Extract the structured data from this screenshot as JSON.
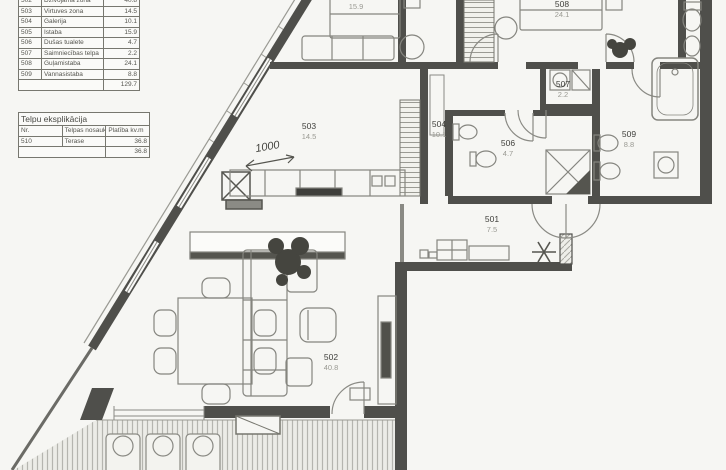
{
  "schedule": {
    "rows": [
      {
        "nr": "502",
        "name": "Dzīvojamā zona",
        "area": "40.8"
      },
      {
        "nr": "503",
        "name": "Virtuves zona",
        "area": "14.5"
      },
      {
        "nr": "504",
        "name": "Galerija",
        "area": "10.1"
      },
      {
        "nr": "505",
        "name": "Istaba",
        "area": "15.9"
      },
      {
        "nr": "506",
        "name": "Dušas tualete",
        "area": "4.7"
      },
      {
        "nr": "507",
        "name": "Saimniecības telpa",
        "area": "2.2"
      },
      {
        "nr": "508",
        "name": "Guļamistaba",
        "area": "24.1"
      },
      {
        "nr": "509",
        "name": "Vannasistaba",
        "area": "8.8"
      }
    ],
    "total": "129.7"
  },
  "explication": {
    "title": "Telpu eksplikācija",
    "headers": {
      "nr": "Nr.",
      "name": "Telpas nosaukums",
      "area": "Platība kv.m"
    },
    "rows": [
      {
        "nr": "510",
        "name": "Terase",
        "area": "36.8"
      }
    ],
    "total": "36.8"
  },
  "plan": {
    "dimension": "1000",
    "entrance_marker": "asterisk-star",
    "rooms": [
      {
        "id": "501",
        "area": "7.5"
      },
      {
        "id": "502",
        "area": "40.8"
      },
      {
        "id": "503",
        "area": "14.5"
      },
      {
        "id": "504",
        "area": "10.1"
      },
      {
        "id": "505",
        "area": "15.9"
      },
      {
        "id": "506",
        "area": "4.7"
      },
      {
        "id": "507",
        "area": "2.2"
      },
      {
        "id": "508",
        "area": "24.1"
      },
      {
        "id": "509",
        "area": "8.8"
      }
    ],
    "colors": {
      "wall": "#4f4f4b",
      "line": "#85857f",
      "paper": "#f6f6f3"
    }
  }
}
